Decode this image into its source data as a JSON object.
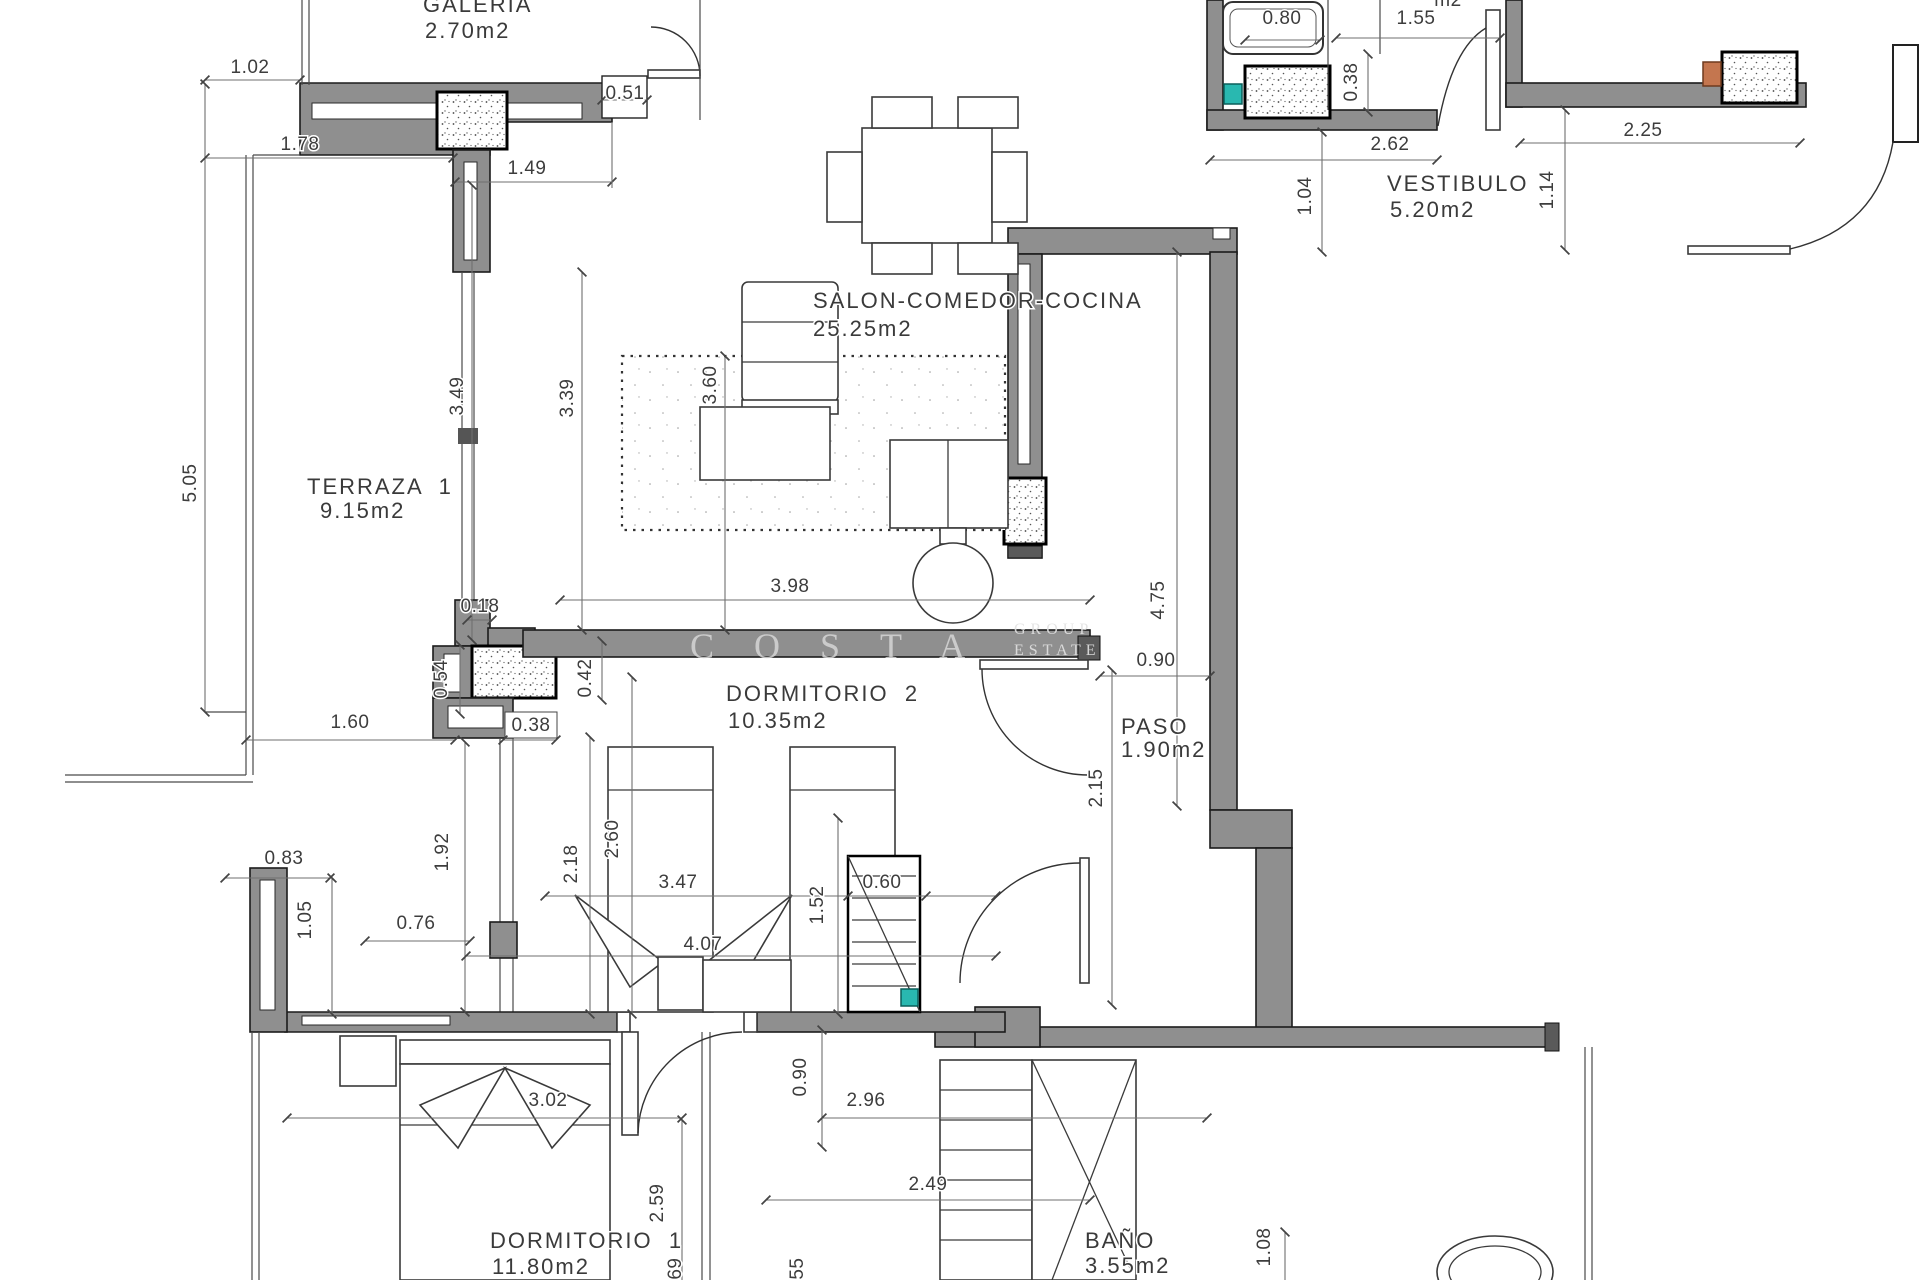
{
  "watermark": {
    "main": "COSTA",
    "sub1": "GROUP",
    "sub2": "ESTATE"
  },
  "rooms": {
    "galeria": {
      "name": "GALERIA",
      "area": "2.70m2"
    },
    "terraza": {
      "name": "TERRAZA  1",
      "area": "9.15m2"
    },
    "salon": {
      "name": "SALON-COMEDOR-COCINA",
      "area": "25.25m2"
    },
    "vestibulo": {
      "name": "VESTIBULO",
      "area": "5.20m2"
    },
    "dormitorio2": {
      "name": "DORMITORIO  2",
      "area": "10.35m2"
    },
    "paso": {
      "name": "PASO",
      "area": "1.90m2"
    },
    "dormitorio1": {
      "name": "DORMITORIO  1",
      "area": "11.80m2"
    },
    "bano": {
      "name": "BAÑO",
      "area": "3.55m2"
    }
  },
  "partial_labels": {
    "top_fragment": "m2"
  },
  "colors": {
    "wall": "#8f8f8f",
    "accent_teal": "#29b8b0",
    "accent_orange": "#c4764f"
  },
  "dimensions": [
    {
      "t": "1.02",
      "x": 250,
      "y": 73,
      "r": 0
    },
    {
      "t": "1.78",
      "x": 300,
      "y": 150,
      "r": 0
    },
    {
      "t": "1.49",
      "x": 527,
      "y": 174,
      "r": 0
    },
    {
      "t": "0.51",
      "x": 625,
      "y": 99,
      "r": 0
    },
    {
      "t": "5.05",
      "x": 196,
      "y": 483,
      "r": -90
    },
    {
      "t": "3.49",
      "x": 463,
      "y": 396,
      "r": -90
    },
    {
      "t": "3.39",
      "x": 573,
      "y": 398,
      "r": -90
    },
    {
      "t": "3.60",
      "x": 716,
      "y": 385,
      "r": -90
    },
    {
      "t": "0.80",
      "x": 1282,
      "y": 24,
      "r": 0
    },
    {
      "t": "0.38",
      "x": 1357,
      "y": 82,
      "r": -90
    },
    {
      "t": "1.55",
      "x": 1416,
      "y": 24,
      "r": 0
    },
    {
      "t": "2.62",
      "x": 1390,
      "y": 150,
      "r": 0
    },
    {
      "t": "1.04",
      "x": 1311,
      "y": 196,
      "r": -90
    },
    {
      "t": "1.14",
      "x": 1553,
      "y": 190,
      "r": -90
    },
    {
      "t": "2.25",
      "x": 1643,
      "y": 136,
      "r": 0
    },
    {
      "t": "3.98",
      "x": 790,
      "y": 592,
      "r": 0
    },
    {
      "t": "4.75",
      "x": 1164,
      "y": 600,
      "r": -90
    },
    {
      "t": "0.90",
      "x": 1156,
      "y": 666,
      "r": 0
    },
    {
      "t": "2.15",
      "x": 1102,
      "y": 788,
      "r": -90
    },
    {
      "t": "0.54",
      "x": 447,
      "y": 679,
      "r": -90
    },
    {
      "t": "0.42",
      "x": 591,
      "y": 678,
      "r": -90
    },
    {
      "t": "0.18",
      "x": 480,
      "y": 612,
      "r": 0
    },
    {
      "t": "1.60",
      "x": 350,
      "y": 728,
      "r": 0
    },
    {
      "t": "0.38",
      "x": 531,
      "y": 731,
      "r": 0
    },
    {
      "t": "1.92",
      "x": 448,
      "y": 852,
      "r": -90
    },
    {
      "t": "0.83",
      "x": 284,
      "y": 864,
      "r": 0
    },
    {
      "t": "1.05",
      "x": 311,
      "y": 920,
      "r": -90
    },
    {
      "t": "0.76",
      "x": 416,
      "y": 929,
      "r": 0
    },
    {
      "t": "2.18",
      "x": 577,
      "y": 864,
      "r": -90
    },
    {
      "t": "2.60",
      "x": 618,
      "y": 839,
      "r": -90
    },
    {
      "t": "3.47",
      "x": 678,
      "y": 888,
      "r": 0
    },
    {
      "t": "4.07",
      "x": 703,
      "y": 950,
      "r": 0
    },
    {
      "t": "1.52",
      "x": 823,
      "y": 905,
      "r": -90
    },
    {
      "t": "0.60",
      "x": 882,
      "y": 888,
      "r": 0
    },
    {
      "t": "0.90",
      "x": 806,
      "y": 1077,
      "r": -90
    },
    {
      "t": "3.02",
      "x": 548,
      "y": 1106,
      "r": 0
    },
    {
      "t": "2.96",
      "x": 866,
      "y": 1106,
      "r": 0
    },
    {
      "t": "2.59",
      "x": 663,
      "y": 1203,
      "r": -90
    },
    {
      "t": "0.69",
      "x": 681,
      "y": 1277,
      "r": -90
    },
    {
      "t": "0.55",
      "x": 803,
      "y": 1277,
      "r": -90
    },
    {
      "t": "2.49",
      "x": 928,
      "y": 1190,
      "r": 0
    },
    {
      "t": "1.08",
      "x": 1270,
      "y": 1247,
      "r": -90
    }
  ]
}
